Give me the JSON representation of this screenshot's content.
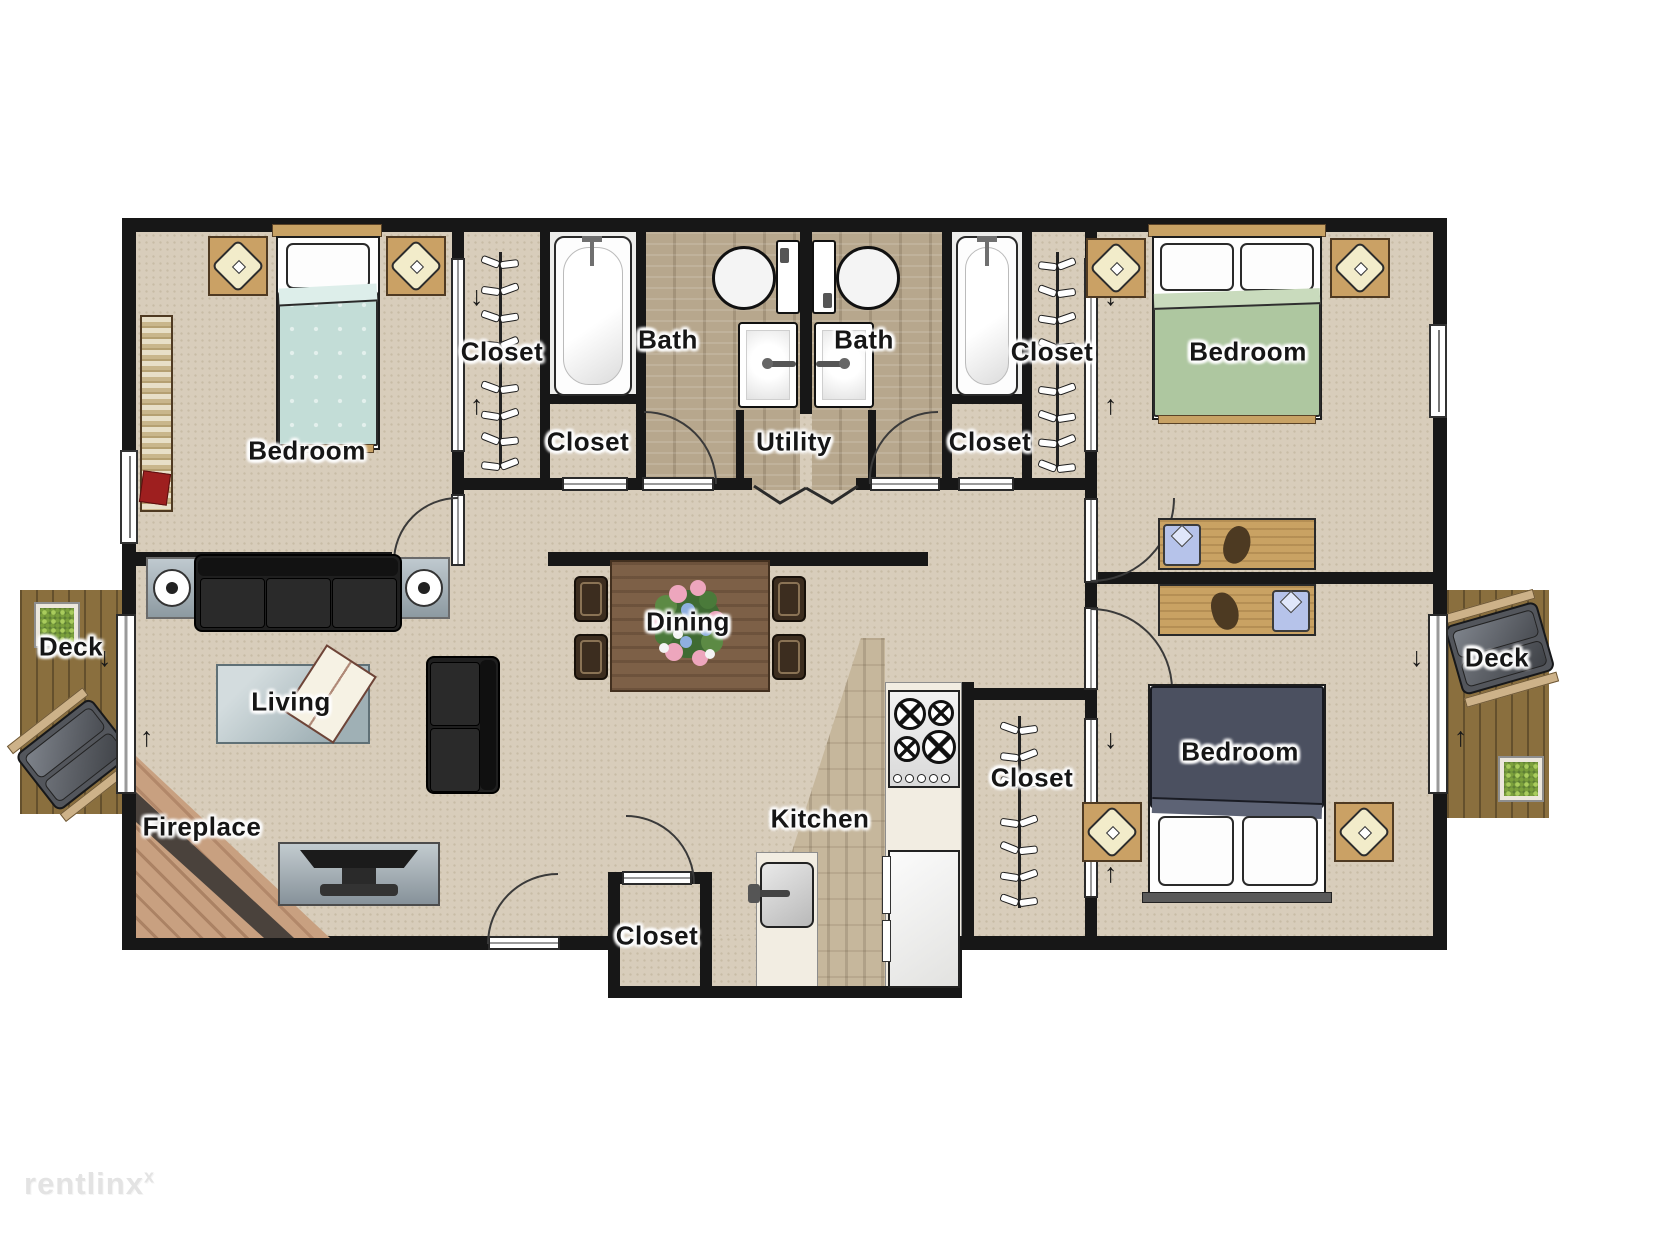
{
  "title": "Apartment floor plan",
  "labels": {
    "bedroom": "Bedroom",
    "closet": "Closet",
    "bath": "Bath",
    "utility": "Utility",
    "dining": "Dining",
    "living": "Living",
    "kitchen": "Kitchen",
    "fireplace": "Fireplace",
    "deck": "Deck"
  },
  "arrows": {
    "down": "↓",
    "up": "↑"
  },
  "watermark": {
    "text": "rentlinx",
    "sup": "x"
  },
  "icons": {
    "fridge-asterisk": "six-spoke-star",
    "hanger": "clothes-hanger-wings",
    "stove-burner": "circle-with-cross",
    "door-arc": "quarter-circle-swing"
  },
  "colors": {
    "wall": "#171717",
    "carpet_floor": "#d8cdbb",
    "bath_wood_floor": "#ab9b81",
    "kitchen_wood_floor": "#bcad92",
    "deck_wood": "#8a6f3e",
    "bed_teal": "#c3ddd7",
    "bed_green": "#aec7a0",
    "bed_navy": "#4b5060",
    "fireplace_brick": "#c49a7a",
    "counter": "#f2ede2",
    "furniture_wood": "#c9a263",
    "sofa_black": "#1f1f1f"
  }
}
